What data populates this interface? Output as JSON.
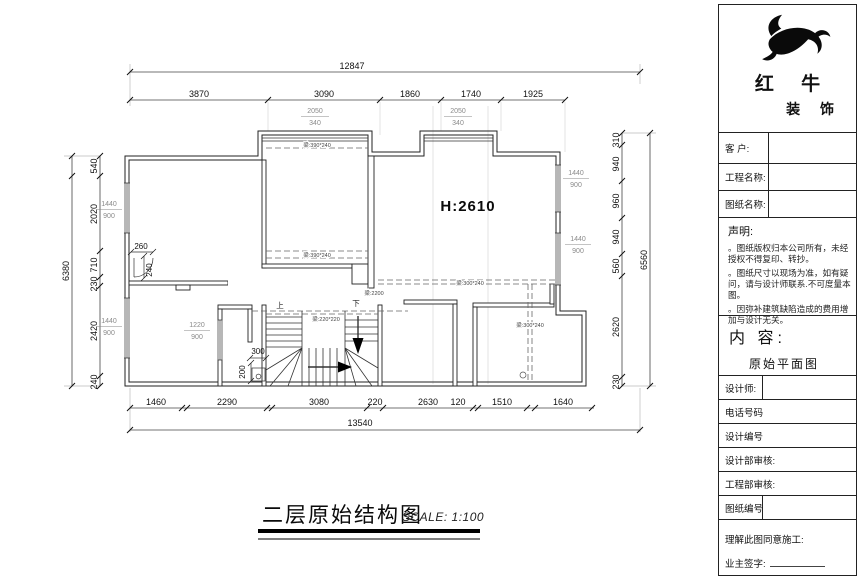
{
  "plan": {
    "title": {
      "name": "二层原始结构图",
      "scale": "SCALE: 1:100"
    },
    "room": {
      "height_label": "H:2610",
      "stair_note": "梁:2200"
    },
    "stairs": {
      "up": "上",
      "down": "下"
    },
    "dims": {
      "top": {
        "total": "12847",
        "segments": [
          "3870",
          "3090",
          "1860",
          "1740",
          "1925"
        ]
      },
      "bottom": {
        "total": "13540",
        "segments": [
          "1460",
          "2290",
          "3080",
          "220",
          "2630",
          "120",
          "1510",
          "1640"
        ]
      },
      "left": {
        "total": "6380",
        "segments": [
          "540",
          "2020",
          "710",
          "230",
          "2420",
          "240"
        ]
      },
      "right": {
        "total": "6560",
        "segments": [
          "310",
          "940",
          "960",
          "940",
          "560",
          "2620",
          "230"
        ]
      },
      "detail": {
        "corner_w": "260",
        "corner_h": "240",
        "stair_w": "300",
        "stair_h": "200"
      }
    },
    "windows": {
      "bay1": {
        "w": "2050",
        "h": "340"
      },
      "bay2": {
        "w": "2050",
        "h": "340"
      },
      "left1": {
        "w": "1440",
        "h": "900"
      },
      "left2": {
        "w": "1440",
        "h": "900"
      },
      "right1": {
        "w": "1440",
        "h": "900"
      },
      "right2": {
        "w": "1440",
        "h": "900"
      },
      "inner1": {
        "w": "1220",
        "h": "900"
      }
    },
    "beams": {
      "mid_top": "梁:390*240",
      "mid_bottom": "梁:390*240",
      "right_h": "梁:300*240",
      "right_v": "梁:300*240",
      "stair": "梁:220*220"
    }
  },
  "titleblock": {
    "brand": {
      "line1": "红 牛",
      "line2": "装 饰"
    },
    "fields": [
      {
        "label": "客  户:"
      },
      {
        "label": "工程名称:"
      },
      {
        "label": "图纸名称:"
      }
    ],
    "statement": {
      "title": "声明:",
      "items": [
        "。图纸版权归本公司所有，未经授权不得复印、转抄。",
        "。图纸尺寸以现场为准，如有疑问，请与设计师联系.不可度量本图。",
        "。因弥补建筑缺陷造成的费用增加与设计无关。"
      ]
    },
    "content": {
      "label": "内  容:",
      "value": "原始平面图"
    },
    "rows": [
      {
        "label": "设计师:"
      },
      {
        "label": "电话号码"
      },
      {
        "label": "设计编号"
      },
      {
        "label": "设计部审核:"
      },
      {
        "label": "工程部审核:"
      },
      {
        "label": "图纸编号"
      }
    ],
    "footer": {
      "line1": "理解此图同意施工:",
      "line2": "业主签字:"
    }
  }
}
